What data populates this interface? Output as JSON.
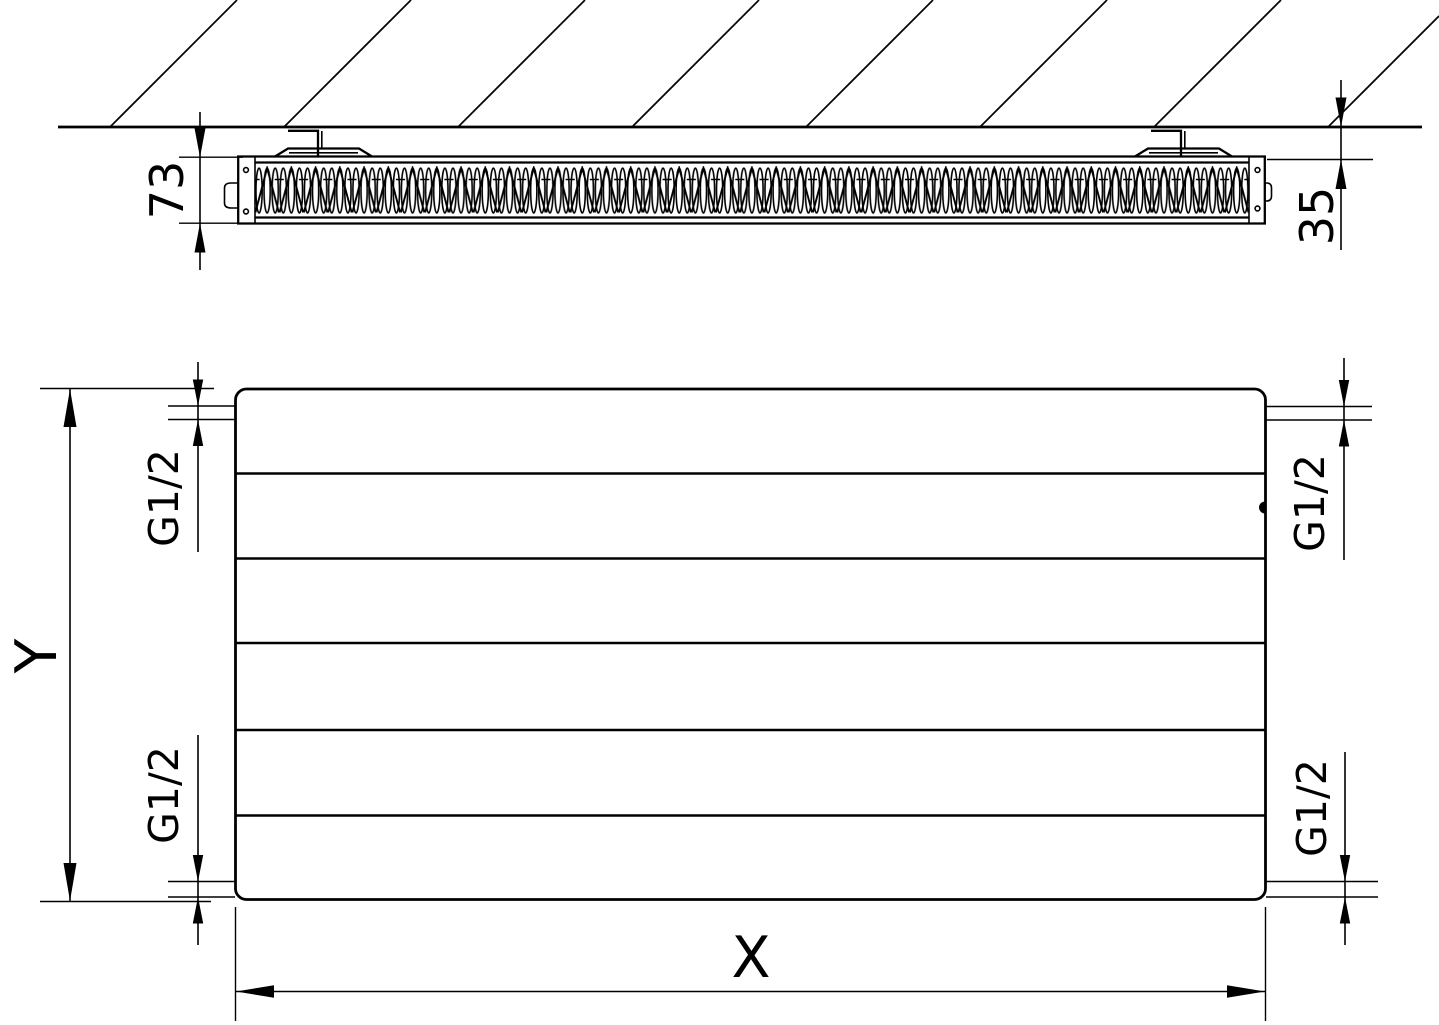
{
  "drawing": {
    "title": "panel radiator technical drawing",
    "background_color": "#ffffff",
    "line_color": "#000000",
    "top_view": {
      "depth_dimension": "73",
      "wall_clearance_dimension": "35"
    },
    "front_view": {
      "height_dimension": "Y",
      "width_dimension": "X",
      "groove_count": 5,
      "connections": [
        {
          "position": "top-left",
          "label": "G1/2"
        },
        {
          "position": "bottom-left",
          "label": "G1/2"
        },
        {
          "position": "top-right",
          "label": "G1/2"
        },
        {
          "position": "bottom-right",
          "label": "G1/2"
        }
      ]
    }
  }
}
